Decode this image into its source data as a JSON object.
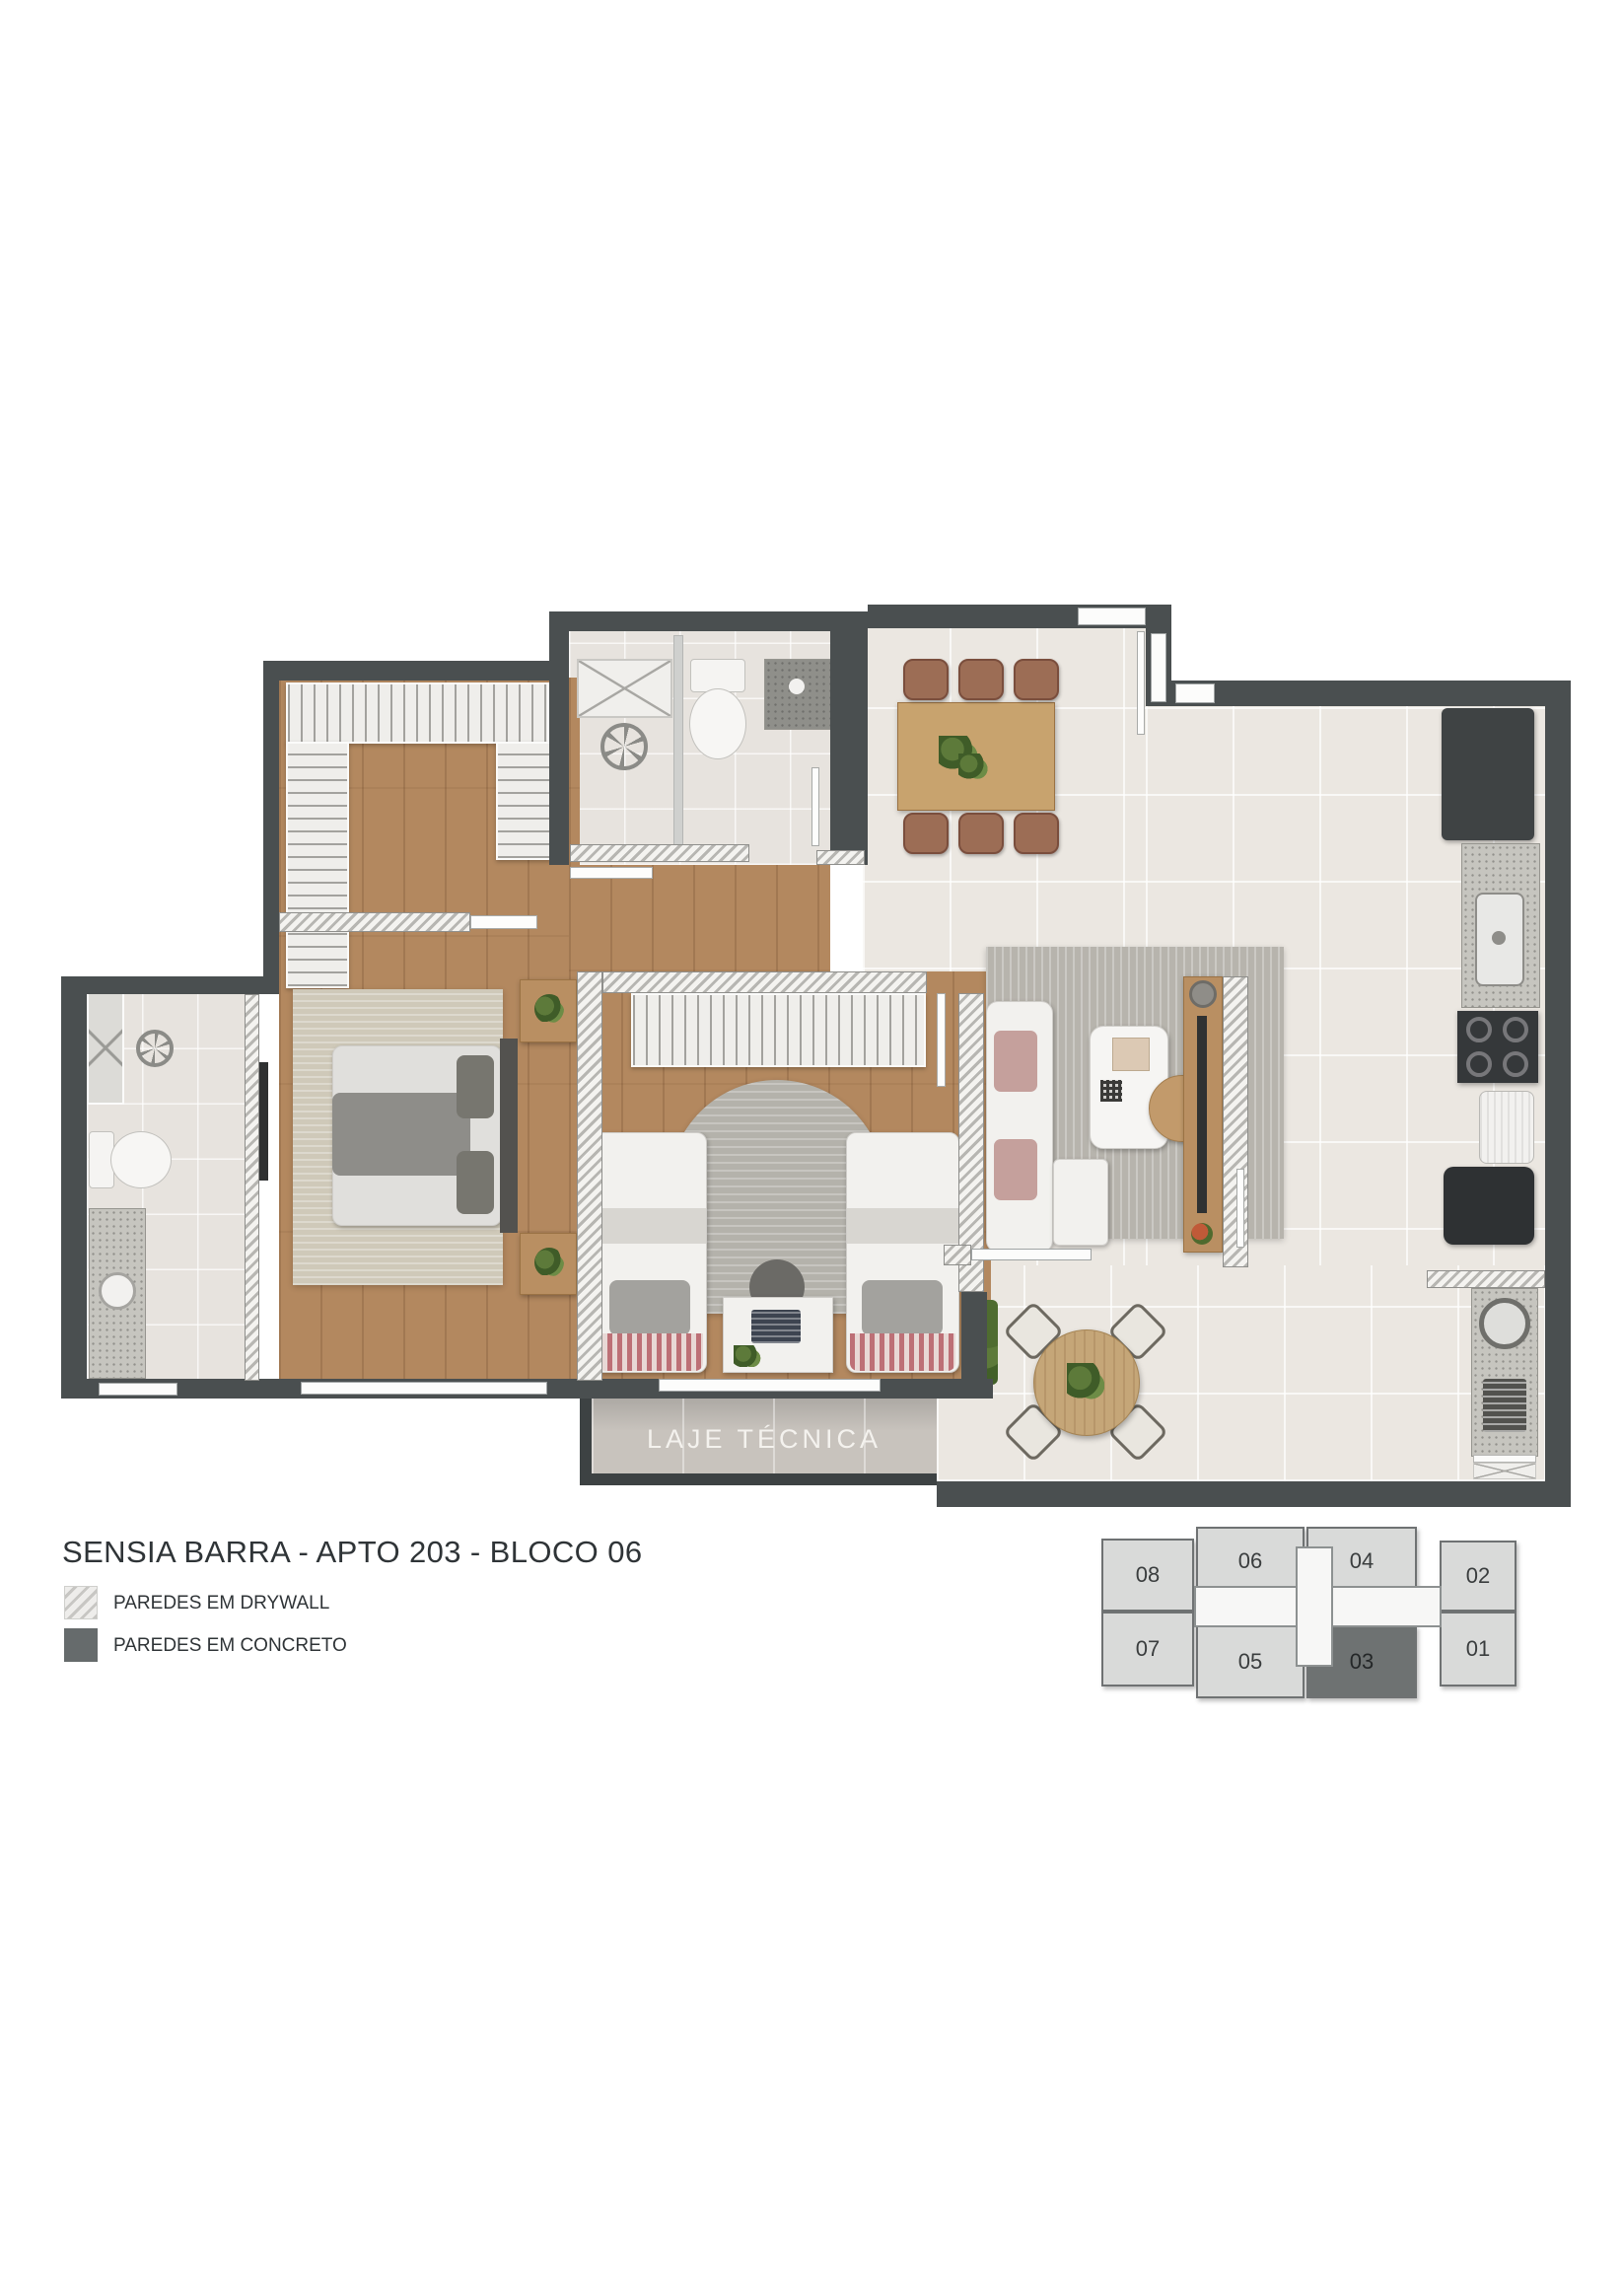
{
  "title": "SENSIA BARRA - APTO 203 - BLOCO 06",
  "legend": {
    "drywall_label": "PAREDES EM DRYWALL",
    "concrete_label": "PAREDES EM CONCRETO"
  },
  "floor_plan": {
    "laje_label": "LAJE TÉCNICA"
  },
  "keyplan": {
    "units": [
      {
        "label": "08",
        "highlighted": false
      },
      {
        "label": "06",
        "highlighted": false
      },
      {
        "label": "04",
        "highlighted": false
      },
      {
        "label": "02",
        "highlighted": false
      },
      {
        "label": "07",
        "highlighted": false
      },
      {
        "label": "05",
        "highlighted": false
      },
      {
        "label": "03",
        "highlighted": true
      },
      {
        "label": "01",
        "highlighted": false
      }
    ]
  },
  "colors": {
    "concrete_wall": "#4a4f50",
    "drywall_hatch": "#c7c6c3",
    "wood_floor": "#b3885f",
    "tile_floor": "#ebe7e1",
    "highlighted_unit": "#6e7272"
  }
}
